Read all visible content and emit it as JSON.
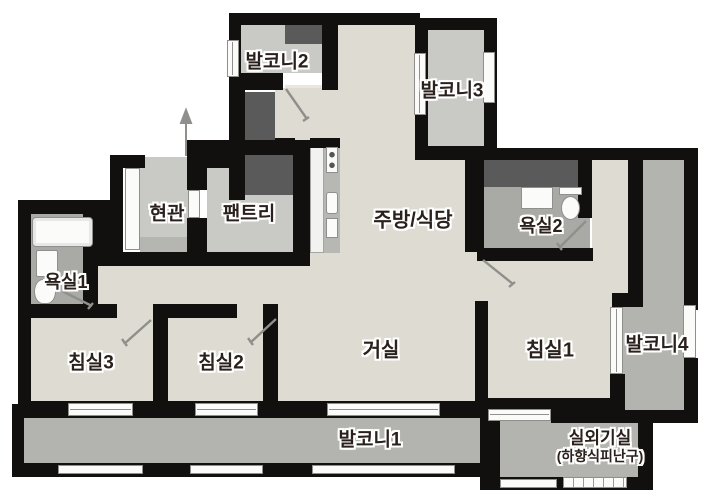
{
  "plan": {
    "rooms": {
      "balcony2": {
        "label": "발코니2"
      },
      "balcony3": {
        "label": "발코니3"
      },
      "entrance": {
        "label": "현관"
      },
      "pantry": {
        "label": "팬트리"
      },
      "kitchen_dining": {
        "label": "주방/식당"
      },
      "bath2": {
        "label": "욕실2"
      },
      "bath1": {
        "label": "욕실1"
      },
      "bedroom3": {
        "label": "침실3"
      },
      "bedroom2": {
        "label": "침실2"
      },
      "living": {
        "label": "거실"
      },
      "bedroom1": {
        "label": "침실1"
      },
      "balcony4": {
        "label": "발코니4"
      },
      "balcony1": {
        "label": "발코니1"
      },
      "outdoor_unit": {
        "label": "실외기실",
        "sublabel": "(하향식피난구)"
      }
    },
    "colors": {
      "wall": "#12100e",
      "floor": "#dedbd2",
      "service": "#c9c9c6",
      "balcony": "#b3b3af",
      "bath": "#a9a9a6",
      "duct": "#5a5a5a",
      "fixture": "#fbfbfa",
      "winline": "#8f8f8c",
      "step": "#b5b5b2",
      "sill": "#eae6da",
      "counter": "#f2f2f0",
      "appliance": "#b7b7b4",
      "label_ink": "#2a211d",
      "door_line": "#8f8f8b",
      "bg": "#ffffff"
    }
  }
}
